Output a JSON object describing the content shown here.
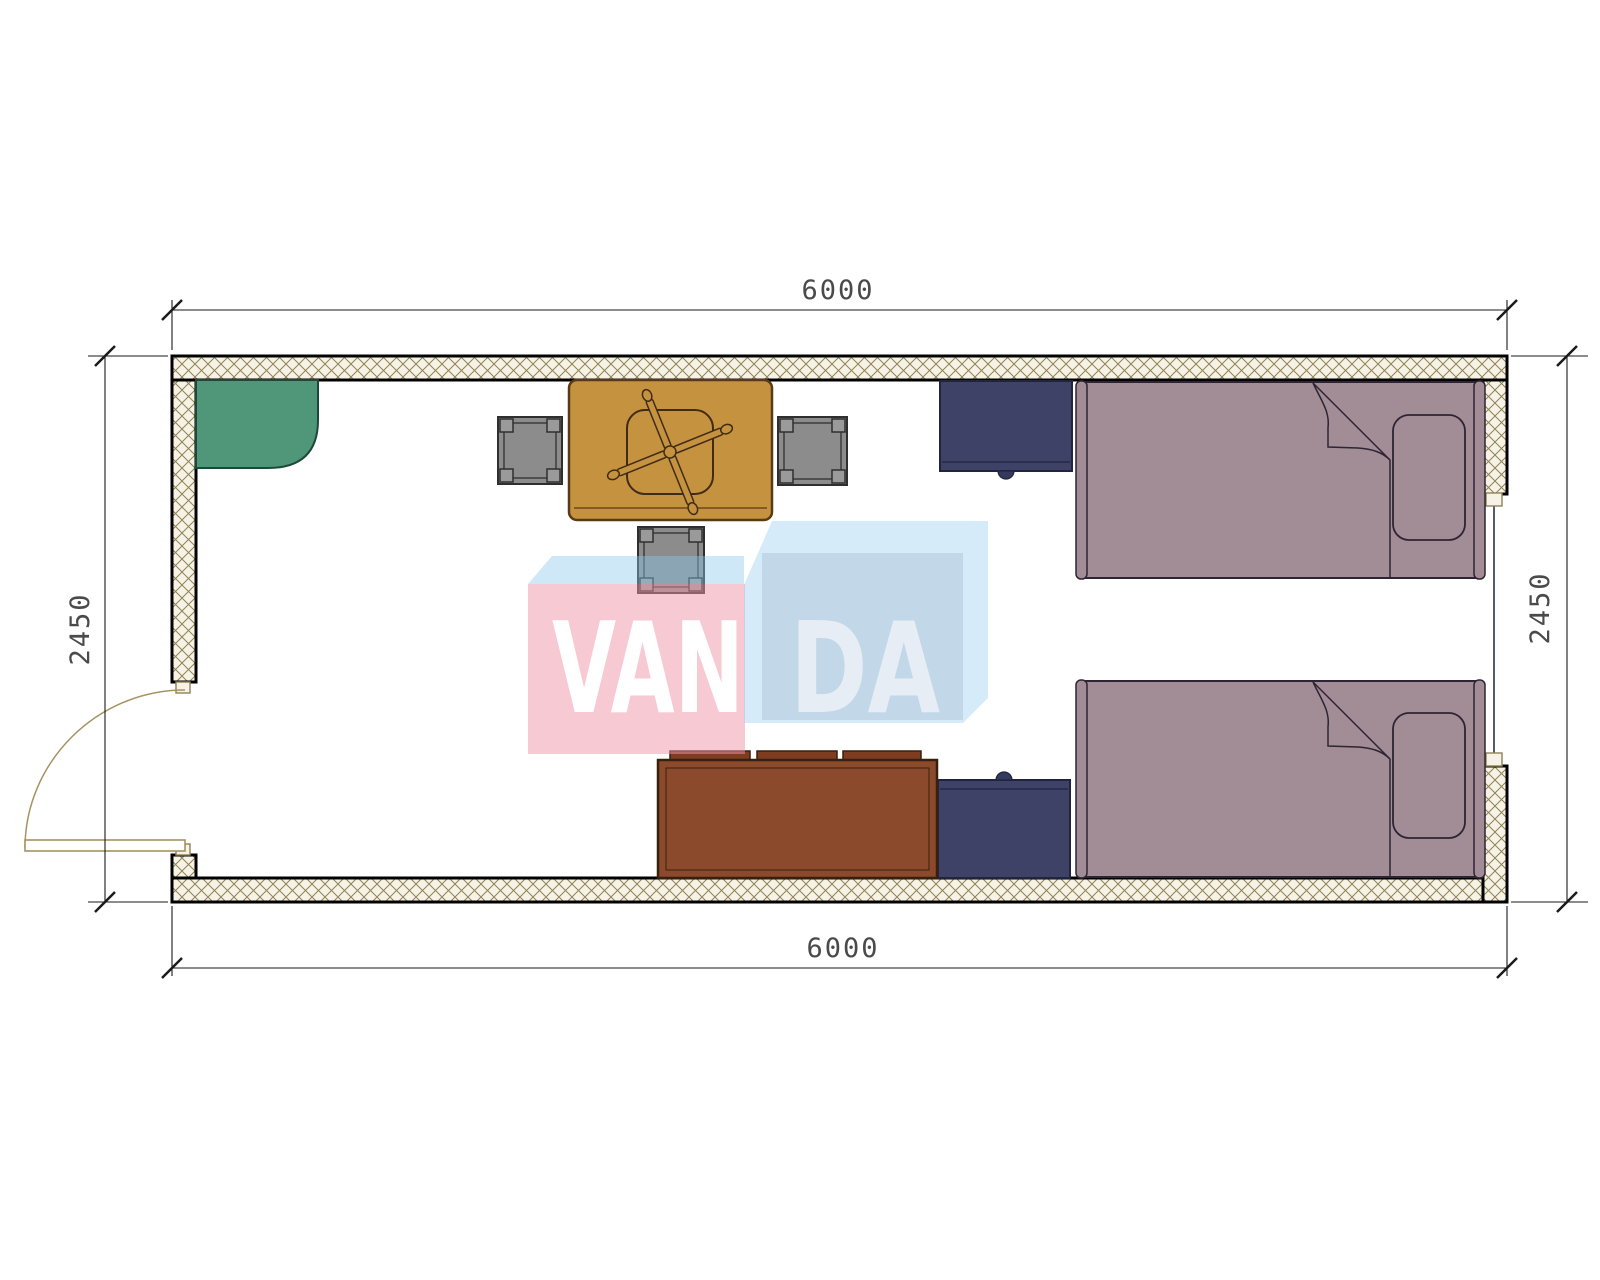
{
  "dimensions": {
    "top_width_mm": "6000",
    "bottom_width_mm": "6000",
    "left_height_mm": "2450",
    "right_height_mm": "2450"
  },
  "watermark": {
    "full_text": "VANDA",
    "text_left": "VAN",
    "text_right": "DA"
  },
  "furniture_items": [
    "corner-cabinet",
    "desk",
    "office-chair",
    "stool-left",
    "stool-right",
    "stool-bottom",
    "nightstand-top",
    "nightstand-bottom",
    "bed-top",
    "bed-bottom",
    "sofa",
    "door",
    "window"
  ],
  "colors": {
    "wall_hatch_bg": "#f6f3e6",
    "wall_hatch_line": "#8f8257",
    "wall_outline": "#000000",
    "dim_line": "#1a1a1a",
    "dim_text": "#4a4a4a",
    "green_fill": "#4f9778",
    "green_outline": "#1d4a38",
    "desk_fill": "#c5923f",
    "desk_outline": "#5a3a14",
    "chair_outline": "#402c16",
    "stool_fill": "#8c8c8c",
    "stool_leg_fill": "#9a9a9a",
    "stool_outline": "#2f2f2f",
    "cabinet_fill": "#3d4266",
    "cabinet_outline": "#20243f",
    "sofa_fill": "#8b4a2b",
    "cushion_fill": "#7e3c20",
    "sofa_outline": "#38200e",
    "bed_fill": "#a28c96",
    "bed_outline": "#2e2433",
    "door_line": "#8f8257",
    "window_line": "#2c3050",
    "wm_pink": "rgba(240,150,168,0.50)",
    "wm_blue_strip": "rgba(140,200,238,0.42)",
    "wm_blue_box": "rgba(150,205,240,0.40)",
    "wm_face": "rgba(120,140,170,0.20)",
    "wm_text_left_color": "#ffffff",
    "wm_text_right_color": "#e7edf4"
  }
}
